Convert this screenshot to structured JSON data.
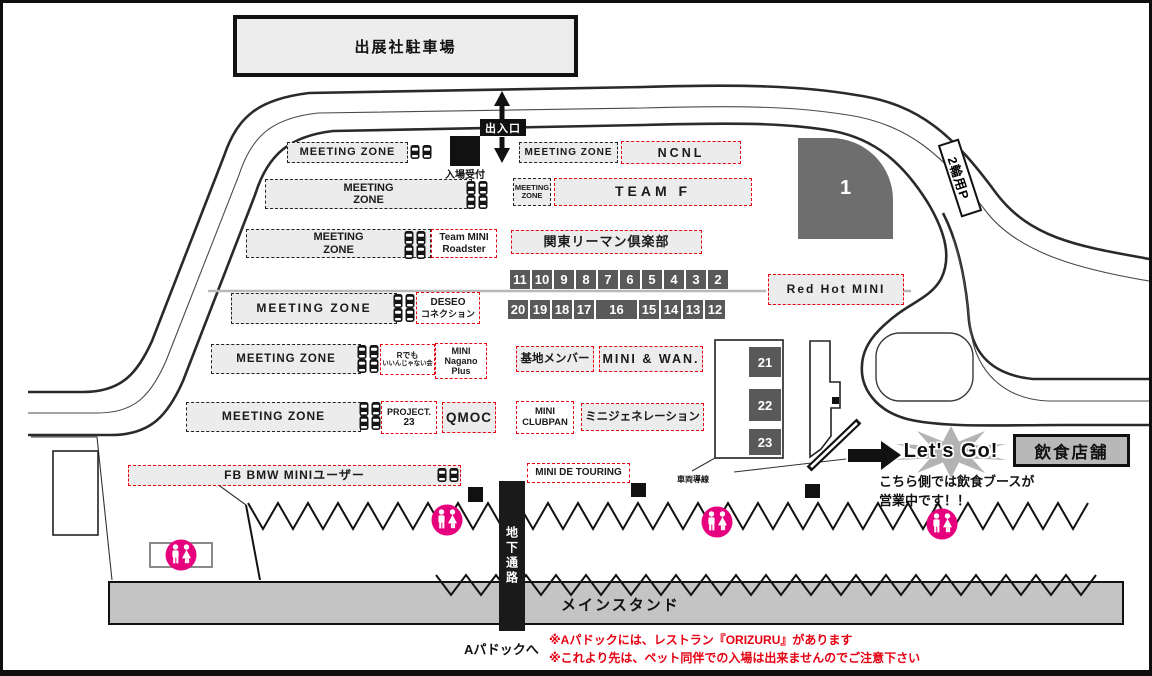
{
  "colors": {
    "accent_red": "#e60012",
    "restroom_magenta": "#e6007e",
    "zone_fill_gray": "#ececec",
    "pit_cell_gray": "#595959",
    "stand_gray": "#c4c4c4"
  },
  "labels": {
    "exhibitor_parking": "出展社駐車場",
    "entrance": "出入口",
    "reception": "入場受付",
    "bike_parking": "2輪用P",
    "area_1": "1",
    "underground_passage": "地下通路",
    "main_stand": "メインスタンド",
    "to_a_paddock": "Aパドックへ",
    "vehicle_guide_line": "車両導線",
    "lets_go": "Let's Go!",
    "food_shops": "飲食店舗",
    "food_info_1": "こちら側では飲食ブースが",
    "food_info_2": "営業中です！！"
  },
  "meeting_zone": {
    "full": "MEETING ZONE",
    "word1": "MEETING",
    "word2": "ZONE"
  },
  "clubs": {
    "ncnl": "NCNL",
    "team_f": "TEAM F",
    "team_mini_roadster": [
      "Team MINI",
      "Roadster"
    ],
    "kanto_riiman": "関東リーマン倶楽部",
    "deseo": [
      "DESEO",
      "コネクション"
    ],
    "r_demo_iinjanai": [
      "Rでも",
      "いいんじゃない会"
    ],
    "mini_nagano_plus": [
      "MINI",
      "Nagano",
      "Plus"
    ],
    "kichi_member": "基地メンバー",
    "mini_and_wan": "MINI & WAN.",
    "project_23": [
      "PROJECT.",
      "23"
    ],
    "qmoc": "QMOC",
    "mini_clubpan": [
      "MINI",
      "CLUBPAN"
    ],
    "mini_generation": "ミニジェネレーション",
    "red_hot_mini": "Red Hot MINI",
    "fb_bmw_mini_user": "FB BMW MINIユーザー",
    "mini_de_touring": "MINI DE TOURING"
  },
  "pit_numbers": {
    "row_top": [
      "11",
      "10",
      "9",
      "8",
      "7",
      "6",
      "5",
      "4",
      "3",
      "2"
    ],
    "row_bottom": [
      "20",
      "19",
      "18",
      "17",
      "16",
      "15",
      "14",
      "13",
      "12"
    ],
    "gates": [
      "21",
      "22",
      "23"
    ]
  },
  "notes": [
    "※Aパドックには、レストラン『ORIZURU』があります",
    "※これより先は、ペット同伴での入場は出来ませんのでご注意下さい"
  ]
}
